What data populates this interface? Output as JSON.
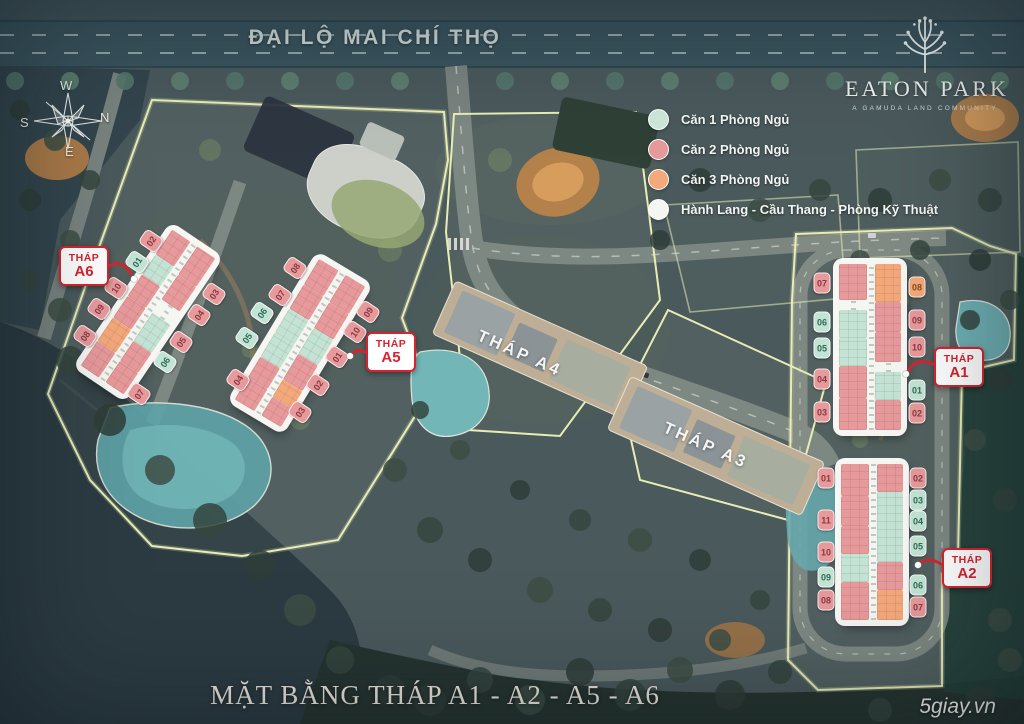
{
  "road": {
    "name": "ĐẠI LỘ MAI CHÍ THỌ"
  },
  "logo": {
    "title": "EATON PARK",
    "tagline": "A GAMUDA LAND COMMUNITY",
    "icon": "tree-icon"
  },
  "compass": {
    "top": "W",
    "right": "N",
    "bottom": "E",
    "left": "S"
  },
  "legend": {
    "items": [
      {
        "type": "1br",
        "label": "Căn 1 Phòng Ngủ",
        "color": "#cde8da"
      },
      {
        "type": "2br",
        "label": "Căn 2 Phòng Ngủ",
        "color": "#e79a9c"
      },
      {
        "type": "3br",
        "label": "Căn 3 Phòng Ngủ",
        "color": "#f4a97b"
      },
      {
        "type": "corridor",
        "label": "Hành Lang - Cầu Thang - Phòng Kỹ Thuật",
        "color": "#f4f6f1"
      }
    ]
  },
  "colors": {
    "accent_red": "#d8232f",
    "boundary_yellow": "#e7edb4",
    "unit_1br": "#c3e4d4",
    "unit_2br": "#e79a9c",
    "unit_3br": "#f4a97b",
    "corridor_white": "#f4f6f1"
  },
  "towers": [
    {
      "id": "a6",
      "prefix": "THÁP",
      "name": "A6",
      "badges": [
        {
          "num": "02",
          "type": "2br"
        },
        {
          "num": "01",
          "type": "1br"
        },
        {
          "num": "10",
          "type": "2br"
        },
        {
          "num": "09",
          "type": "2br"
        },
        {
          "num": "08",
          "type": "2br"
        },
        {
          "num": "03",
          "type": "2br"
        },
        {
          "num": "04",
          "type": "2br"
        },
        {
          "num": "05",
          "type": "2br"
        },
        {
          "num": "06",
          "type": "1br"
        },
        {
          "num": "07",
          "type": "2br"
        }
      ]
    },
    {
      "id": "a5",
      "prefix": "THÁP",
      "name": "A5",
      "badges": [
        {
          "num": "08",
          "type": "2br"
        },
        {
          "num": "07",
          "type": "2br"
        },
        {
          "num": "06",
          "type": "1br"
        },
        {
          "num": "05",
          "type": "1br"
        },
        {
          "num": "04",
          "type": "2br"
        },
        {
          "num": "09",
          "type": "2br"
        },
        {
          "num": "10",
          "type": "2br"
        },
        {
          "num": "01",
          "type": "2br"
        },
        {
          "num": "02",
          "type": "2br"
        },
        {
          "num": "03",
          "type": "2br"
        }
      ]
    },
    {
      "id": "a1",
      "prefix": "THÁP",
      "name": "A1",
      "badges": [
        {
          "num": "07",
          "type": "2br"
        },
        {
          "num": "06",
          "type": "1br"
        },
        {
          "num": "05",
          "type": "1br"
        },
        {
          "num": "04",
          "type": "2br"
        },
        {
          "num": "03",
          "type": "2br"
        },
        {
          "num": "08",
          "type": "3br"
        },
        {
          "num": "09",
          "type": "2br"
        },
        {
          "num": "10",
          "type": "2br"
        },
        {
          "num": "01",
          "type": "1br"
        },
        {
          "num": "02",
          "type": "2br"
        }
      ]
    },
    {
      "id": "a2",
      "prefix": "THÁP",
      "name": "A2",
      "badges": [
        {
          "num": "01",
          "type": "2br"
        },
        {
          "num": "11",
          "type": "2br"
        },
        {
          "num": "10",
          "type": "2br"
        },
        {
          "num": "09",
          "type": "1br"
        },
        {
          "num": "08",
          "type": "2br"
        },
        {
          "num": "02",
          "type": "2br"
        },
        {
          "num": "03",
          "type": "1br"
        },
        {
          "num": "04",
          "type": "1br"
        },
        {
          "num": "05",
          "type": "1br"
        },
        {
          "num": "06",
          "type": "1br"
        },
        {
          "num": "07",
          "type": "2br"
        }
      ]
    }
  ],
  "center_towers": [
    {
      "name": "THÁP A4"
    },
    {
      "name": "THÁP A3"
    }
  ],
  "footer": {
    "title": "MẶT BẰNG THÁP A1 - A2 - A5 - A6"
  },
  "watermark": "5giay.vn"
}
